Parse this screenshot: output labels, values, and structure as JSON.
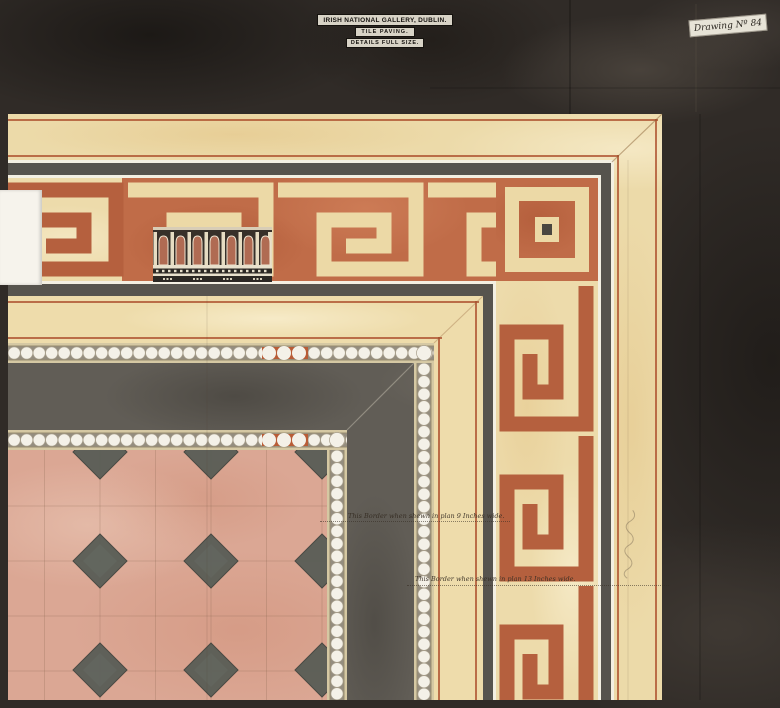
{
  "artwork": {
    "title_block": {
      "line1": "IRISH NATIONAL GALLERY, DUBLIN.",
      "line2": "TILE PAVING.",
      "line3": "DETAILS FULL SIZE."
    },
    "drawing_number": "Drawing Nº 84",
    "annotations": {
      "inner_border": "This Border when shewn in plan 9 Inches wide.",
      "outer_border": "This Border when shewn in plan 13 Inches wide."
    },
    "colors": {
      "background_wash": "#302b27",
      "cream_band": "#ecdaa9",
      "terracotta_key": "#c06c48",
      "pinstripe_red": "#ac4e2b",
      "grey_band": "#615d56",
      "bead_white": "#f4f1e8",
      "pink_tile": "#dba794",
      "diamond_grey": "#595d56"
    }
  }
}
